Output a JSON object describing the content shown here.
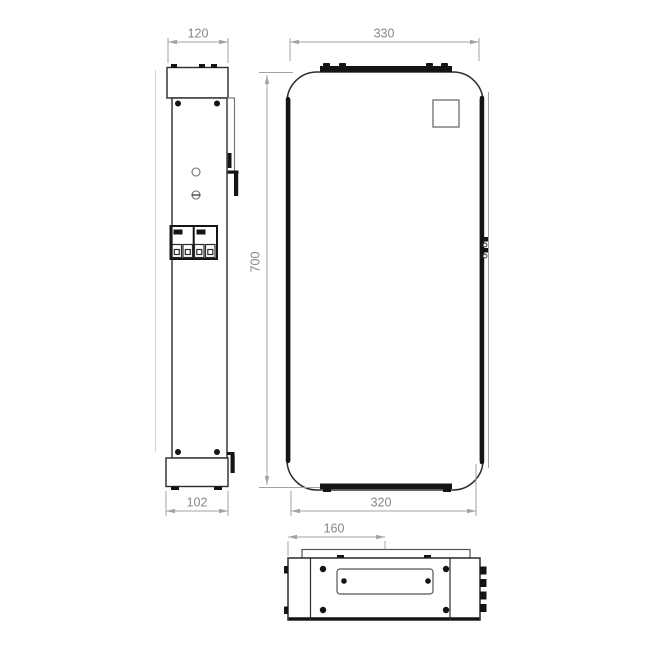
{
  "views": {
    "side": {
      "top_width": "120",
      "base_width": "102"
    },
    "front": {
      "top_width": "330",
      "height": "700",
      "bottom_width": "320"
    },
    "bottom": {
      "flange_offset": "160"
    }
  },
  "colors": {
    "outline": "#2b2b2b",
    "solid_detail": "#141414",
    "secondary_line": "#6e6e6e",
    "dimension_line": "#a3a3a3",
    "dimension_text": "#878787",
    "background": "#ffffff"
  }
}
